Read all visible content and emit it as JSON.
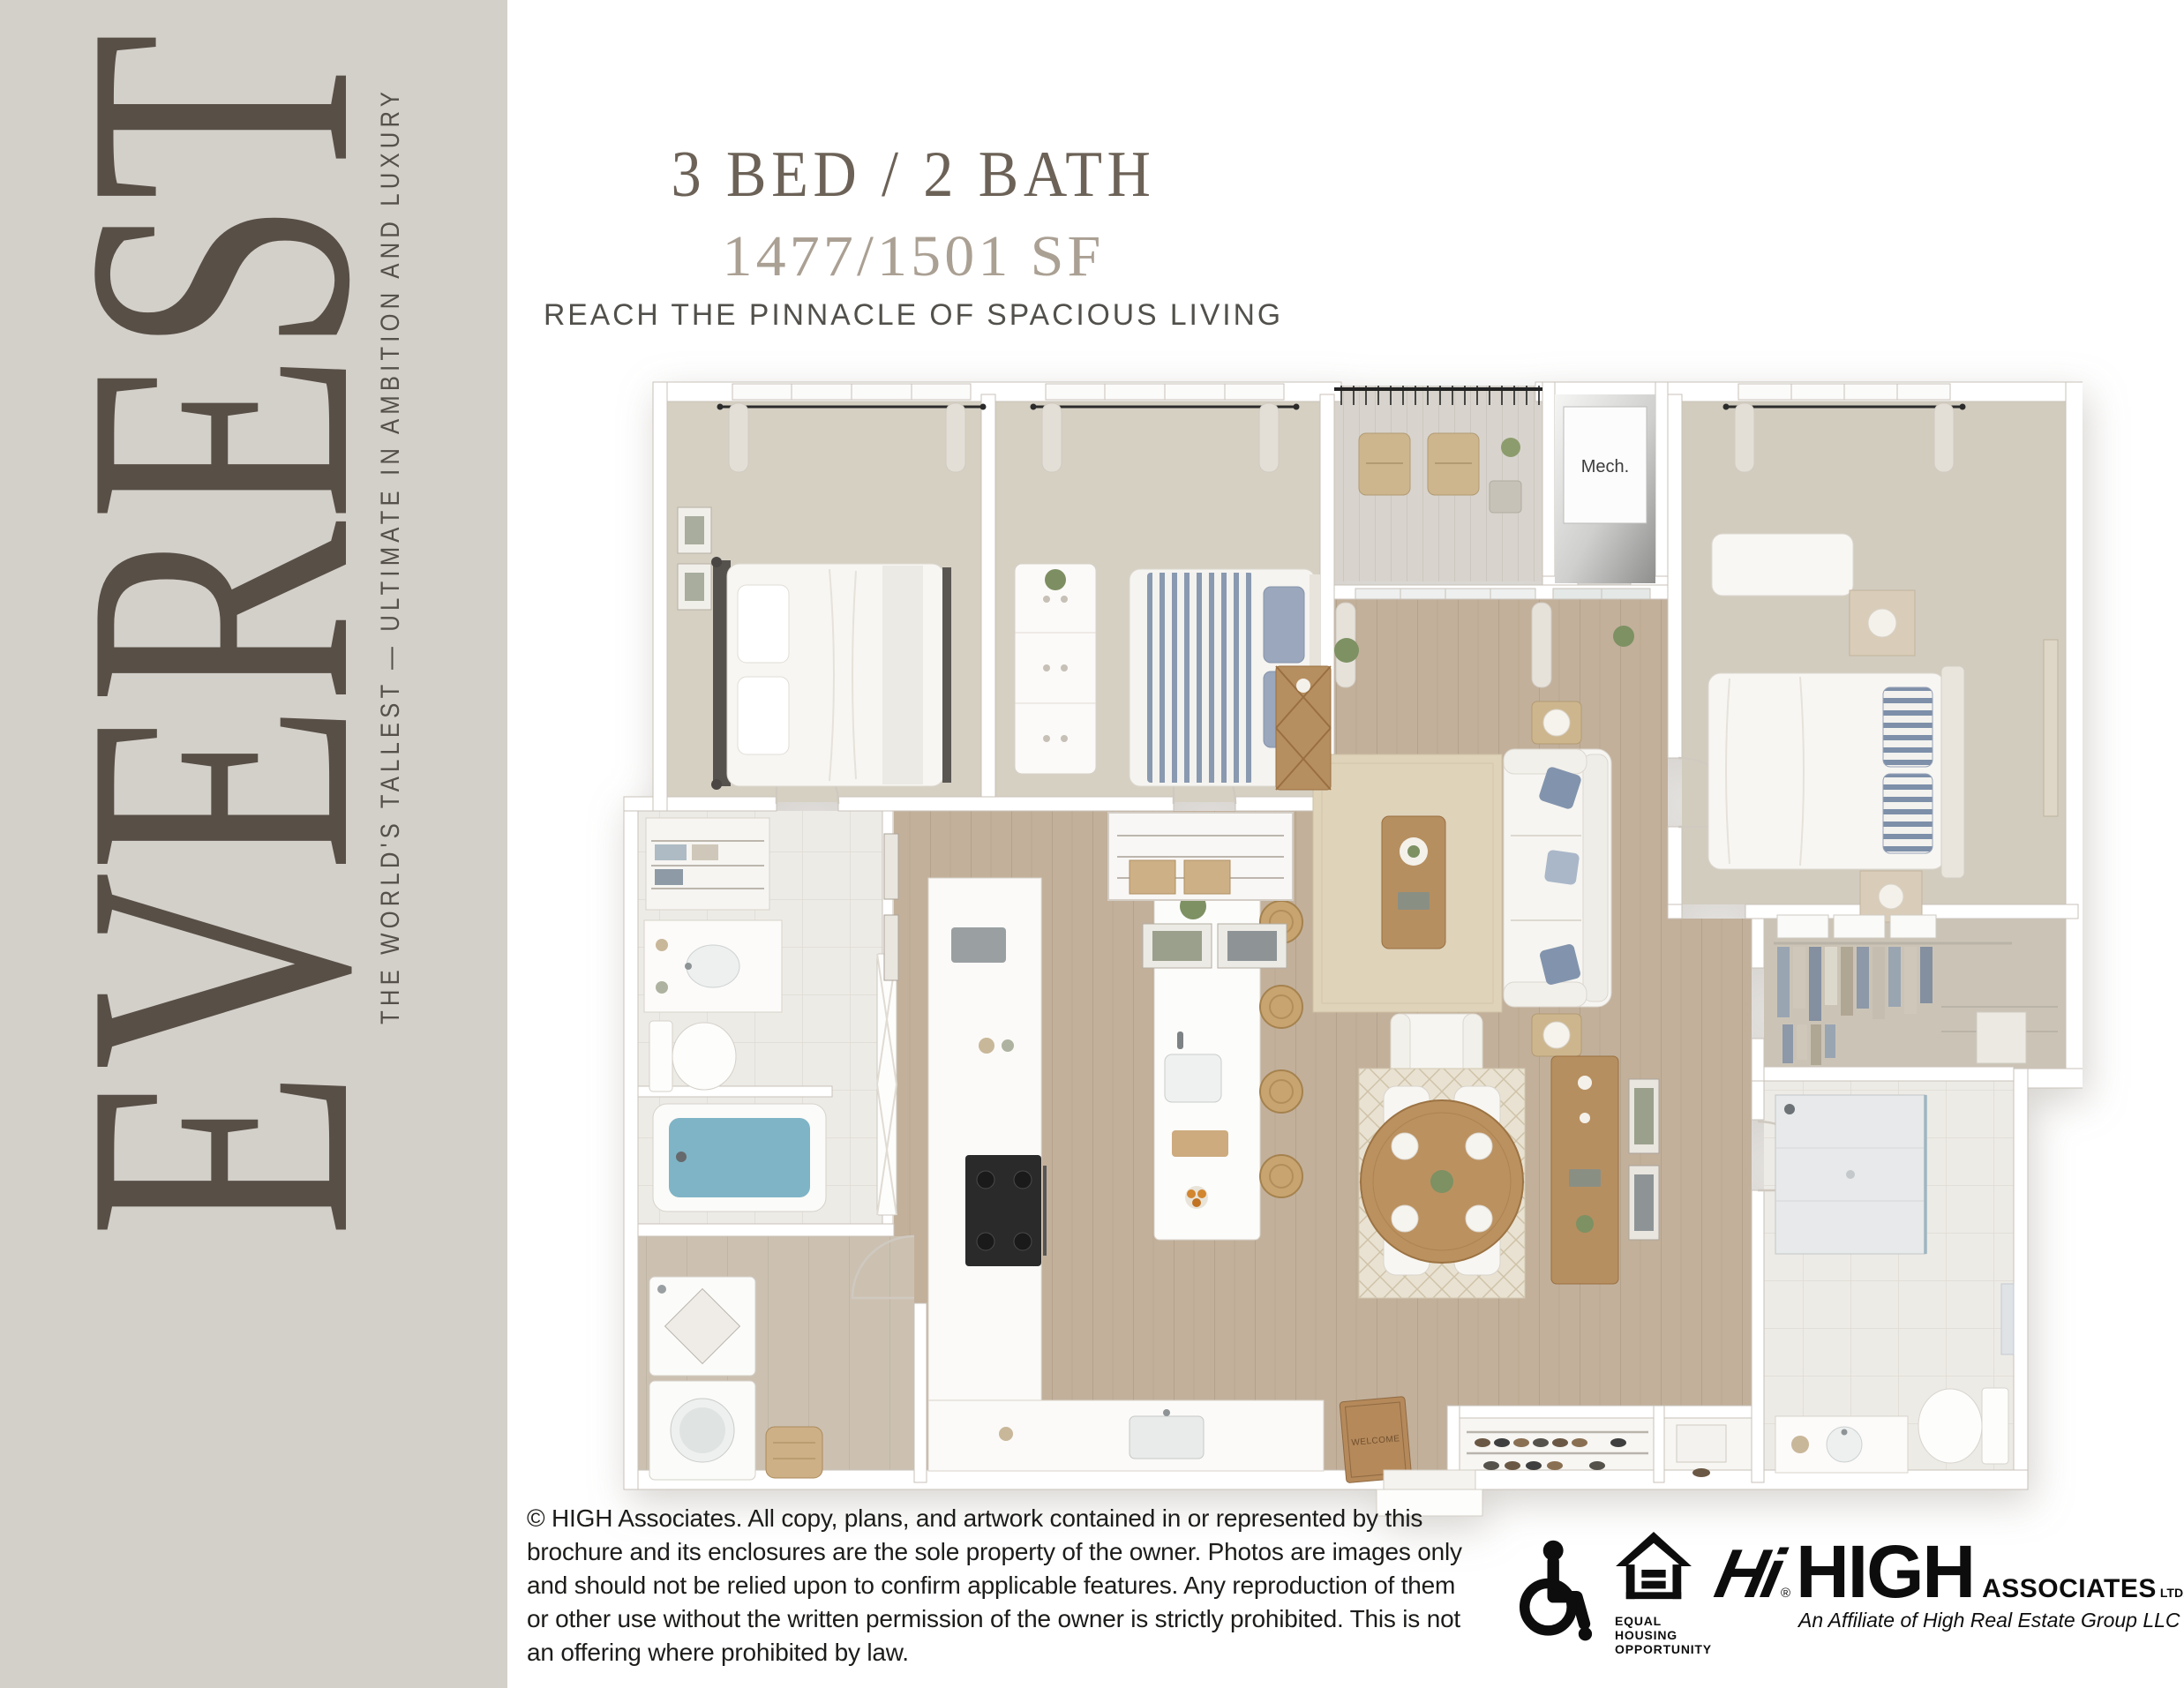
{
  "brand": {
    "name": "EVEREST",
    "tagline": "THE WORLD'S TALLEST — ULTIMATE IN AMBITION AND LUXURY"
  },
  "header": {
    "title": "3 BED / 2 BATH",
    "area": "1477/1501 SF",
    "tagline": "REACH THE PINNACLE OF SPACIOUS LIVING"
  },
  "floorplan": {
    "mech_label": "Mech.",
    "welcome_mat": "WELCOME"
  },
  "footer": {
    "copyright_lines": [
      "© HIGH Associates. All copy, plans, and artwork contained in or represented by this",
      "brochure and its enclosures are the sole property of the owner. Photos are images only",
      "and should not be relied upon to confirm applicable features. Any reproduction of them",
      "or other use without the written permission of the owner is strictly prohibited. This is not",
      "an offering where prohibited by law."
    ],
    "equal_housing": {
      "line1": "EQUAL HOUSING",
      "line2": "OPPORTUNITY"
    },
    "high_logo": {
      "glyph": "Hi",
      "registered": "®",
      "name": "HIGH",
      "associates": "ASSOCIATES",
      "ltd": "LTD.",
      "affiliate": "An Affiliate of High Real Estate Group LLC"
    }
  },
  "colors": {
    "sidebar_bg": "#d3d0ca",
    "brand_text": "#584f47",
    "title_text": "#6c6257",
    "area_text": "#aaa093",
    "logo_black": "#0d0d0d"
  }
}
